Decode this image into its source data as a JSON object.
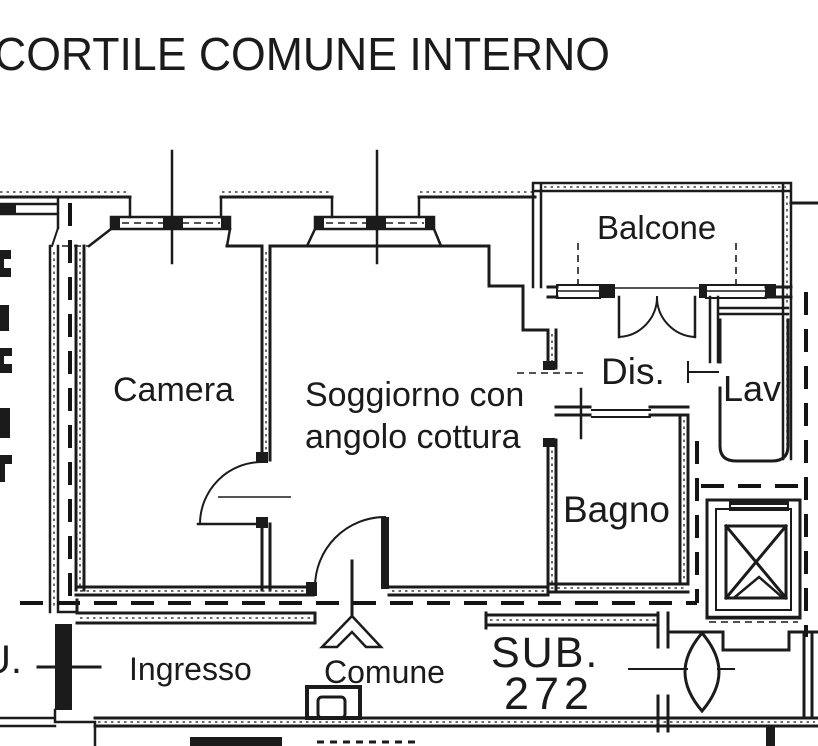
{
  "title": "CORTILE COMUNE INTERNO",
  "plan": {
    "rooms": {
      "camera": "Camera",
      "soggiorno_line1": "Soggiorno con",
      "soggiorno_line2": "angolo cottura",
      "balcone": "Balcone",
      "dis": "Dis.",
      "lav": "Lav",
      "bagno": "Bagno"
    },
    "common_areas": {
      "ingresso": "Ingresso",
      "comune": "Comune",
      "sub_label": "SUB.",
      "sub_number": "272"
    },
    "edge_labels": {
      "left_cutoff": "U."
    },
    "colors": {
      "ink": "#1b1b1b",
      "paper": "#ffffff"
    }
  }
}
